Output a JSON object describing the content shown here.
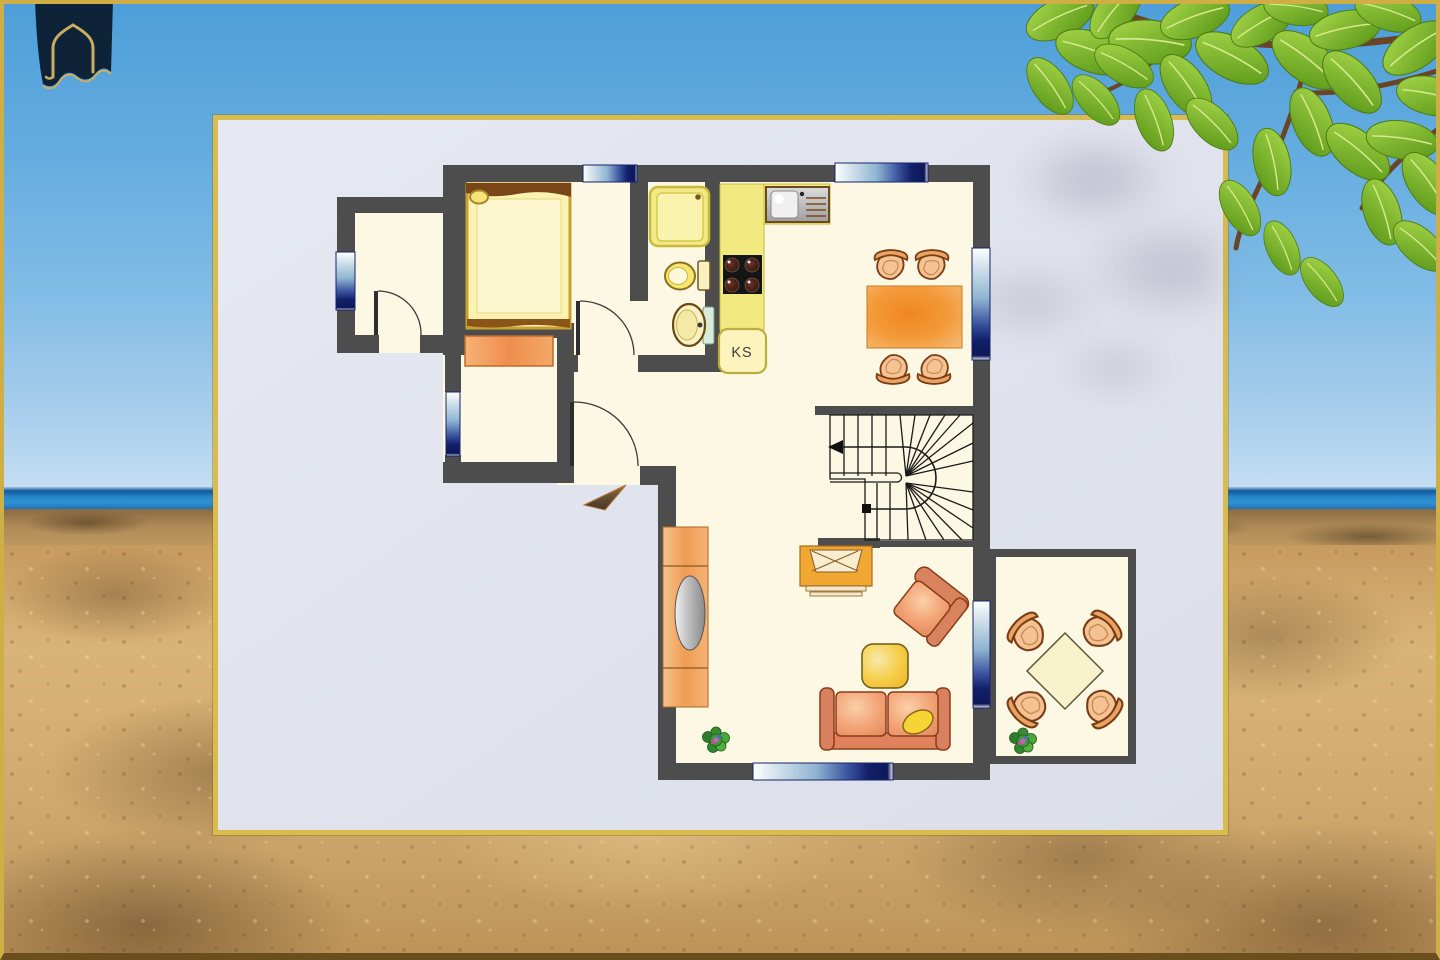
{
  "scene": {
    "description": "beach-photo-backdrop-with-floor-plan-panel",
    "environment": {
      "sky": "#63acdf",
      "sea": "#2586c8",
      "sand": "#d2ab70",
      "leaves": "#76b322"
    }
  },
  "logo": {
    "icon": "arched-house-banner-icon",
    "navy": "#0e2238",
    "gold": "#c9ae62"
  },
  "floor_plan": {
    "fridge_label": "KS",
    "colors": {
      "wall": "#4d4d4d",
      "floor": "#fdf8e3",
      "panel": "#e0e3ed",
      "panel_border": "#d9bc4e",
      "window_navy": "#101e66",
      "furniture_orange": "#ef9a64",
      "counter_yellow": "#f2ea80",
      "table_orange": "#f08a28",
      "coffee_table_yellow": "#f7cf4a"
    },
    "elements": [
      "bed",
      "dresser",
      "shower",
      "toilet",
      "washbasin",
      "kitchen-counter",
      "kitchen-sink",
      "stove",
      "refrigerator",
      "dining-table",
      "dining-chairs",
      "staircase",
      "sideboard",
      "armchair",
      "coffee-table",
      "sofa",
      "wall-unit",
      "plant",
      "terrace-table",
      "terrace-chairs",
      "entrance-arrow",
      "windows",
      "doors"
    ]
  }
}
